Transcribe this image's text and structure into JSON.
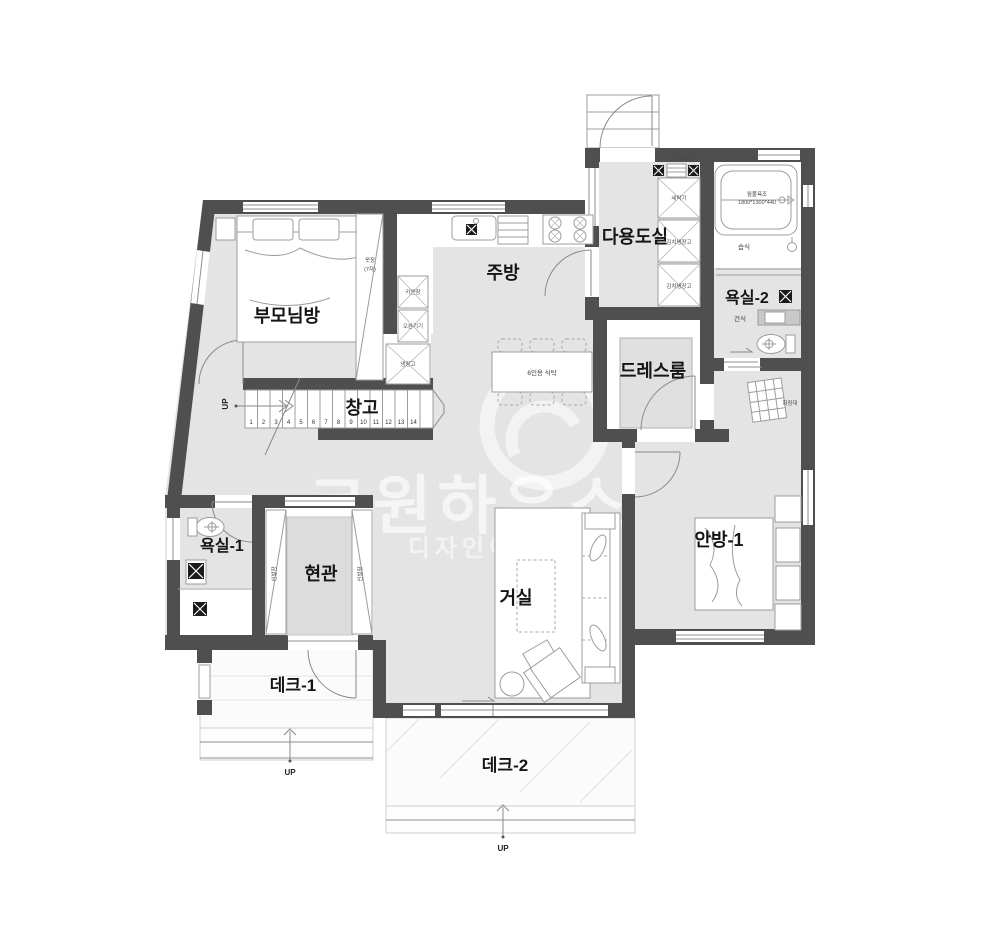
{
  "rooms": {
    "utility": "다용도실",
    "bath2": "욕실-2",
    "dressroom": "드레스룸",
    "kitchen": "주방",
    "parents_room": "부모님방",
    "storage": "창고",
    "bath1": "욕실-1",
    "entrance": "현관",
    "living": "거실",
    "master_room": "안방-1",
    "deck1": "데크-1",
    "deck2": "데크-2"
  },
  "fixtures": {
    "washer": "세탁기",
    "kimchi_fridge_1": "김치냉장고",
    "kimchi_fridge_2": "김치냉장고",
    "boiler": "※도시가스보일러",
    "whirlpool": "월풀욕조",
    "whirlpool_size": "1800*1300*440",
    "wet_zone": "습식",
    "dry_zone": "건식",
    "vanity": "화장대",
    "wardrobe": "옷장",
    "wardrobe_size": "(7자)",
    "tall_cabinet": "키큰장",
    "oven": "오븐기기",
    "fridge": "냉장고",
    "dining_table": "6인용 식탁",
    "shoe_cabinet_left": "신발장",
    "shoe_cabinet_right": "신발장"
  },
  "stairs": {
    "numbers": [
      "1",
      "2",
      "3",
      "4",
      "5",
      "6",
      "7",
      "8",
      "9",
      "10",
      "11",
      "12",
      "13",
      "14"
    ],
    "up": "UP"
  },
  "decks": {
    "up1": "UP",
    "up2": "UP"
  },
  "watermark": {
    "brand": "코원하우스",
    "tagline": "디자인이"
  },
  "colors": {
    "wall": "#4f4f4f",
    "floor": "#e4e4e4"
  }
}
